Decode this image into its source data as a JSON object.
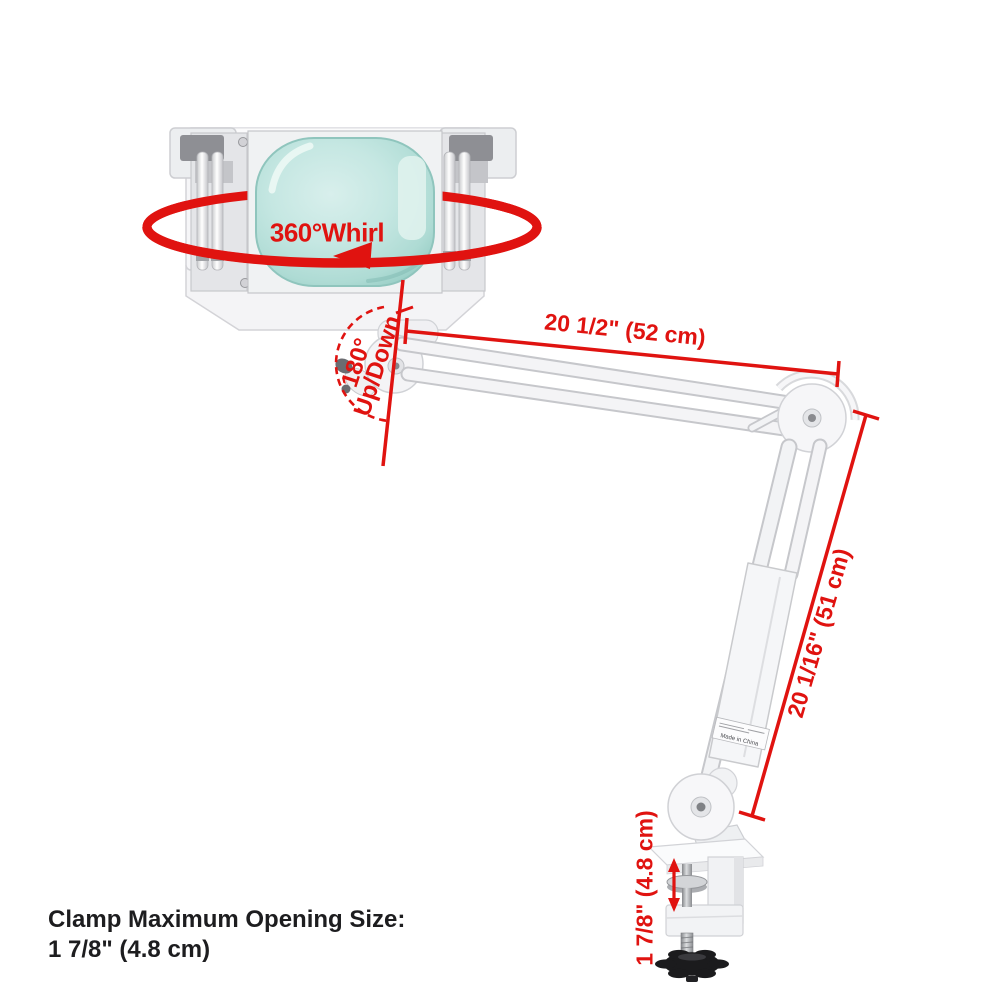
{
  "labels": {
    "whirl": "360°Whirl",
    "angle": "180°",
    "updown": "Up/Down",
    "upper_arm": "20 1/2\" (52 cm)",
    "lower_arm": "20 1/16\" (51 cm)",
    "clamp_opening": "1 7/8\" (4.8 cm)",
    "made_in": "Made in China"
  },
  "note": {
    "line1": "Clamp Maximum Opening Size:",
    "line2": "1 7/8\" (4.8 cm)"
  },
  "colors": {
    "annotation_red": "#e01310",
    "lens_teal": "#bfe4df",
    "text_black": "#1d1d1f"
  }
}
